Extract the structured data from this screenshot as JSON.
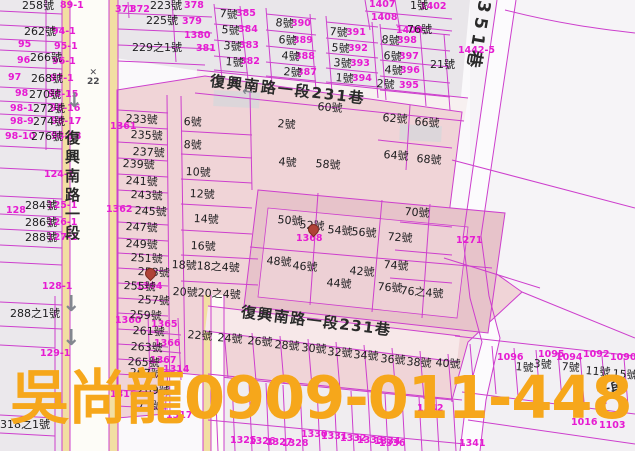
{
  "watermark": {
    "text": "吳尚龍0909-011-448",
    "color": "#f6a71b"
  },
  "street_labels": [
    {
      "text": "復興南路一段",
      "x": 64,
      "y": 130,
      "vertical": true,
      "fs": 15,
      "ls": 4
    },
    {
      "text": "復興南路一段231巷",
      "x": 211,
      "y": 74,
      "rot": 6.5,
      "fs": 15,
      "ls": 2
    },
    {
      "text": "復興南路一段231巷",
      "x": 242,
      "y": 305,
      "rot": 7,
      "fs": 15,
      "ls": 1.5
    },
    {
      "text": "351巷",
      "x": 492,
      "y": 2,
      "rot": 100,
      "fs": 17,
      "ls": 5
    },
    {
      "text": "一段",
      "x": 596,
      "y": 386,
      "rot": -12,
      "fs": 13,
      "ls": 1
    }
  ],
  "house_numbers": [
    {
      "t": "258號",
      "x": 22,
      "y": 0
    },
    {
      "t": "262號",
      "x": 24,
      "y": 26
    },
    {
      "t": "266號",
      "x": 30,
      "y": 52
    },
    {
      "t": "268號",
      "x": 31,
      "y": 73
    },
    {
      "t": "270號",
      "x": 29,
      "y": 89
    },
    {
      "t": "272號",
      "x": 33,
      "y": 103
    },
    {
      "t": "274號",
      "x": 33,
      "y": 116
    },
    {
      "t": "276號",
      "x": 31,
      "y": 131
    },
    {
      "t": "284號",
      "x": 25,
      "y": 200
    },
    {
      "t": "286號",
      "x": 25,
      "y": 217
    },
    {
      "t": "288號",
      "x": 25,
      "y": 232
    },
    {
      "t": "288之1號",
      "x": 10,
      "y": 308
    },
    {
      "t": "318之1號",
      "x": 0,
      "y": 419
    },
    {
      "t": "223號",
      "x": 150,
      "y": 0
    },
    {
      "t": "225號",
      "x": 146,
      "y": 15
    },
    {
      "t": "229之1號",
      "x": 132,
      "y": 42
    },
    {
      "t": "1號",
      "x": 410,
      "y": 0
    },
    {
      "t": "76號",
      "x": 407,
      "y": 24
    },
    {
      "t": "21號",
      "x": 430,
      "y": 59
    },
    {
      "t": "7號",
      "x": 220,
      "y": 8,
      "rot": 5
    },
    {
      "t": "5號",
      "x": 222,
      "y": 24,
      "rot": 5
    },
    {
      "t": "3號",
      "x": 224,
      "y": 40,
      "rot": 5
    },
    {
      "t": "1號",
      "x": 226,
      "y": 56,
      "rot": 5
    },
    {
      "t": "8號",
      "x": 276,
      "y": 17,
      "rot": 5
    },
    {
      "t": "6號",
      "x": 279,
      "y": 34,
      "rot": 5
    },
    {
      "t": "4號",
      "x": 282,
      "y": 50,
      "rot": 5
    },
    {
      "t": "2號",
      "x": 284,
      "y": 66,
      "rot": 5
    },
    {
      "t": "7號",
      "x": 330,
      "y": 26,
      "rot": 5
    },
    {
      "t": "5號",
      "x": 332,
      "y": 42,
      "rot": 5
    },
    {
      "t": "3號",
      "x": 334,
      "y": 57,
      "rot": 5
    },
    {
      "t": "1號",
      "x": 336,
      "y": 72,
      "rot": 5
    },
    {
      "t": "8號",
      "x": 382,
      "y": 34,
      "rot": 5
    },
    {
      "t": "6號",
      "x": 384,
      "y": 50,
      "rot": 5
    },
    {
      "t": "4號",
      "x": 385,
      "y": 64,
      "rot": 5
    },
    {
      "t": "2號",
      "x": 377,
      "y": 78,
      "rot": 5
    },
    {
      "t": "233號",
      "x": 126,
      "y": 113,
      "rot": 3
    },
    {
      "t": "235號",
      "x": 131,
      "y": 129,
      "rot": 3
    },
    {
      "t": "237號",
      "x": 133,
      "y": 146,
      "rot": 3
    },
    {
      "t": "239號",
      "x": 123,
      "y": 158,
      "rot": 3
    },
    {
      "t": "241號",
      "x": 126,
      "y": 175,
      "rot": 3
    },
    {
      "t": "243號",
      "x": 131,
      "y": 189,
      "rot": 3
    },
    {
      "t": "245號",
      "x": 135,
      "y": 205,
      "rot": 3
    },
    {
      "t": "247號",
      "x": 126,
      "y": 221,
      "rot": 3
    },
    {
      "t": "249號",
      "x": 126,
      "y": 238,
      "rot": 3
    },
    {
      "t": "251號",
      "x": 131,
      "y": 252,
      "rot": 3
    },
    {
      "t": "253號",
      "x": 138,
      "y": 266,
      "rot": 3
    },
    {
      "t": "255號",
      "x": 124,
      "y": 280,
      "rot": 3
    },
    {
      "t": "257號",
      "x": 138,
      "y": 294,
      "rot": 3
    },
    {
      "t": "259號",
      "x": 130,
      "y": 309,
      "rot": 3
    },
    {
      "t": "261號",
      "x": 133,
      "y": 325,
      "rot": 3
    },
    {
      "t": "263號",
      "x": 131,
      "y": 341,
      "rot": 3
    },
    {
      "t": "265號",
      "x": 128,
      "y": 356,
      "rot": 3
    },
    {
      "t": "267號",
      "x": 130,
      "y": 367,
      "rot": 3
    },
    {
      "t": "269號",
      "x": 138,
      "y": 384,
      "rot": 3
    },
    {
      "t": "271號",
      "x": 131,
      "y": 399,
      "rot": 3
    },
    {
      "t": "6號",
      "x": 184,
      "y": 116,
      "rot": 3
    },
    {
      "t": "8號",
      "x": 184,
      "y": 139,
      "rot": 3
    },
    {
      "t": "10號",
      "x": 186,
      "y": 166,
      "rot": 3
    },
    {
      "t": "12號",
      "x": 190,
      "y": 188,
      "rot": 3
    },
    {
      "t": "14號",
      "x": 194,
      "y": 213,
      "rot": 3
    },
    {
      "t": "16號",
      "x": 191,
      "y": 240,
      "rot": 3
    },
    {
      "t": "18號18之4號",
      "x": 172,
      "y": 259,
      "rot": 3
    },
    {
      "t": "20號20之4號",
      "x": 173,
      "y": 286,
      "rot": 3
    },
    {
      "t": "2號",
      "x": 278,
      "y": 118,
      "rot": 5
    },
    {
      "t": "60號",
      "x": 318,
      "y": 101,
      "rot": 5
    },
    {
      "t": "62號",
      "x": 383,
      "y": 112,
      "rot": 5
    },
    {
      "t": "66號",
      "x": 415,
      "y": 116,
      "rot": 5
    },
    {
      "t": "64號",
      "x": 384,
      "y": 149,
      "rot": 5
    },
    {
      "t": "68號",
      "x": 417,
      "y": 153,
      "rot": 5
    },
    {
      "t": "4號",
      "x": 279,
      "y": 156,
      "rot": 5
    },
    {
      "t": "58號",
      "x": 316,
      "y": 158,
      "rot": 5
    },
    {
      "t": "50號",
      "x": 278,
      "y": 214,
      "rot": 5
    },
    {
      "t": "52號",
      "x": 300,
      "y": 219,
      "rot": 5
    },
    {
      "t": "54號",
      "x": 328,
      "y": 224,
      "rot": 5
    },
    {
      "t": "56號",
      "x": 352,
      "y": 226,
      "rot": 5
    },
    {
      "t": "48號",
      "x": 267,
      "y": 255,
      "rot": 5
    },
    {
      "t": "46號",
      "x": 293,
      "y": 260,
      "rot": 5
    },
    {
      "t": "44號",
      "x": 327,
      "y": 277,
      "rot": 5
    },
    {
      "t": "42號",
      "x": 350,
      "y": 265,
      "rot": 5
    },
    {
      "t": "70號",
      "x": 405,
      "y": 206,
      "rot": 5
    },
    {
      "t": "72號",
      "x": 388,
      "y": 231,
      "rot": 5
    },
    {
      "t": "74號",
      "x": 384,
      "y": 259,
      "rot": 5
    },
    {
      "t": "76號",
      "x": 378,
      "y": 281,
      "rot": 5
    },
    {
      "t": "76之4號",
      "x": 401,
      "y": 285,
      "rot": 5
    },
    {
      "t": "22號",
      "x": 188,
      "y": 329,
      "rot": 5
    },
    {
      "t": "24號",
      "x": 218,
      "y": 332,
      "rot": 5
    },
    {
      "t": "26號",
      "x": 248,
      "y": 335,
      "rot": 5
    },
    {
      "t": "28號",
      "x": 275,
      "y": 339,
      "rot": 5
    },
    {
      "t": "30號",
      "x": 302,
      "y": 342,
      "rot": 5
    },
    {
      "t": "32號",
      "x": 328,
      "y": 346,
      "rot": 5
    },
    {
      "t": "34號",
      "x": 354,
      "y": 349,
      "rot": 5
    },
    {
      "t": "36號",
      "x": 381,
      "y": 353,
      "rot": 5
    },
    {
      "t": "38號",
      "x": 407,
      "y": 356,
      "rot": 5
    },
    {
      "t": "40號",
      "x": 436,
      "y": 357,
      "rot": 5
    },
    {
      "t": "1號",
      "x": 516,
      "y": 361,
      "rot": 5
    },
    {
      "t": "3號",
      "x": 534,
      "y": 358,
      "rot": 5
    },
    {
      "t": "7號",
      "x": 562,
      "y": 361,
      "rot": 5
    },
    {
      "t": "11號",
      "x": 586,
      "y": 365,
      "rot": 5
    },
    {
      "t": "15號",
      "x": 613,
      "y": 368,
      "rot": 5
    }
  ],
  "lot_numbers": [
    {
      "t": "89-1",
      "x": 60,
      "y": 1
    },
    {
      "t": "94-1",
      "x": 52,
      "y": 27
    },
    {
      "t": "95",
      "x": 18,
      "y": 40
    },
    {
      "t": "95-1",
      "x": 54,
      "y": 42
    },
    {
      "t": "96",
      "x": 17,
      "y": 56
    },
    {
      "t": "96-1",
      "x": 52,
      "y": 57
    },
    {
      "t": "97",
      "x": 8,
      "y": 73
    },
    {
      "t": "97-1",
      "x": 50,
      "y": 74
    },
    {
      "t": "98",
      "x": 15,
      "y": 89
    },
    {
      "t": "98-15",
      "x": 48,
      "y": 90
    },
    {
      "t": "98-1",
      "x": 10,
      "y": 104
    },
    {
      "t": "98-16",
      "x": 50,
      "y": 104
    },
    {
      "t": "98-9",
      "x": 10,
      "y": 117
    },
    {
      "t": "98-17",
      "x": 51,
      "y": 117
    },
    {
      "t": "98-10",
      "x": 5,
      "y": 132
    },
    {
      "t": "98-18",
      "x": 51,
      "y": 132
    },
    {
      "t": "124-1",
      "x": 44,
      "y": 170
    },
    {
      "t": "125-1",
      "x": 47,
      "y": 201
    },
    {
      "t": "128",
      "x": 6,
      "y": 206
    },
    {
      "t": "126-1",
      "x": 47,
      "y": 218
    },
    {
      "t": "127-1",
      "x": 47,
      "y": 233
    },
    {
      "t": "128-1",
      "x": 42,
      "y": 282
    },
    {
      "t": "129-1",
      "x": 40,
      "y": 349
    },
    {
      "t": "371",
      "x": 115,
      "y": 5
    },
    {
      "t": "372",
      "x": 130,
      "y": 5
    },
    {
      "t": "378",
      "x": 184,
      "y": 1
    },
    {
      "t": "379",
      "x": 182,
      "y": 17
    },
    {
      "t": "1380",
      "x": 184,
      "y": 31
    },
    {
      "t": "381",
      "x": 196,
      "y": 44
    },
    {
      "t": "1407",
      "x": 369,
      "y": 0
    },
    {
      "t": "1408",
      "x": 371,
      "y": 13
    },
    {
      "t": "1402",
      "x": 420,
      "y": 2
    },
    {
      "t": "1406",
      "x": 396,
      "y": 26
    },
    {
      "t": "1442-5",
      "x": 458,
      "y": 46
    },
    {
      "t": "1271",
      "x": 456,
      "y": 236
    },
    {
      "t": "385",
      "x": 236,
      "y": 9
    },
    {
      "t": "384",
      "x": 238,
      "y": 25
    },
    {
      "t": "383",
      "x": 239,
      "y": 41
    },
    {
      "t": "382",
      "x": 240,
      "y": 57
    },
    {
      "t": "390",
      "x": 291,
      "y": 19
    },
    {
      "t": "389",
      "x": 293,
      "y": 36
    },
    {
      "t": "388",
      "x": 295,
      "y": 52
    },
    {
      "t": "387",
      "x": 297,
      "y": 68
    },
    {
      "t": "391",
      "x": 346,
      "y": 28
    },
    {
      "t": "392",
      "x": 348,
      "y": 44
    },
    {
      "t": "393",
      "x": 350,
      "y": 59
    },
    {
      "t": "394",
      "x": 352,
      "y": 74
    },
    {
      "t": "398",
      "x": 397,
      "y": 36
    },
    {
      "t": "397",
      "x": 399,
      "y": 52
    },
    {
      "t": "396",
      "x": 400,
      "y": 66
    },
    {
      "t": "395",
      "x": 399,
      "y": 81
    },
    {
      "t": "1361",
      "x": 110,
      "y": 122
    },
    {
      "t": "1362",
      "x": 106,
      "y": 205
    },
    {
      "t": "1364",
      "x": 136,
      "y": 282
    },
    {
      "t": "1360",
      "x": 115,
      "y": 316
    },
    {
      "t": "1365",
      "x": 151,
      "y": 320
    },
    {
      "t": "1366",
      "x": 154,
      "y": 339
    },
    {
      "t": "1367",
      "x": 150,
      "y": 356
    },
    {
      "t": "1314",
      "x": 163,
      "y": 365
    },
    {
      "t": "1316",
      "x": 110,
      "y": 390
    },
    {
      "t": "1317",
      "x": 166,
      "y": 411
    },
    {
      "t": "1368",
      "x": 296,
      "y": 234
    },
    {
      "t": "1096",
      "x": 497,
      "y": 353
    },
    {
      "t": "1095",
      "x": 538,
      "y": 350
    },
    {
      "t": "1094",
      "x": 556,
      "y": 353
    },
    {
      "t": "1092",
      "x": 583,
      "y": 350
    },
    {
      "t": "1090",
      "x": 610,
      "y": 353
    },
    {
      "t": "1016",
      "x": 571,
      "y": 418
    },
    {
      "t": "1103",
      "x": 599,
      "y": 421
    },
    {
      "t": "1342",
      "x": 417,
      "y": 404
    },
    {
      "t": "1341",
      "x": 459,
      "y": 439
    },
    {
      "t": "1336",
      "x": 379,
      "y": 439
    },
    {
      "t": "1325",
      "x": 230,
      "y": 436
    },
    {
      "t": "1326",
      "x": 249,
      "y": 437
    },
    {
      "t": "1327",
      "x": 266,
      "y": 438
    },
    {
      "t": "1328",
      "x": 282,
      "y": 439
    },
    {
      "t": "1330",
      "x": 301,
      "y": 430
    },
    {
      "t": "1331",
      "x": 321,
      "y": 432
    },
    {
      "t": "1332",
      "x": 340,
      "y": 434
    },
    {
      "t": "1333",
      "x": 357,
      "y": 436
    },
    {
      "t": "1334",
      "x": 374,
      "y": 437
    }
  ],
  "markers": {
    "arrows": [
      {
        "g": "↓",
        "x": 66,
        "y": 90,
        "fs": 20
      },
      {
        "g": "↓",
        "x": 62,
        "y": 294,
        "fs": 22
      },
      {
        "g": "↓",
        "x": 62,
        "y": 328,
        "fs": 22
      },
      {
        "g": "←",
        "x": 243,
        "y": 85,
        "fs": 13,
        "rot": 7
      }
    ],
    "station": {
      "symbol": "✕",
      "label": "22",
      "x": 87,
      "y": 69
    },
    "pins": [
      {
        "x": 308,
        "y": 224
      },
      {
        "x": 145,
        "y": 268
      }
    ]
  },
  "colors": {
    "line_magenta": "#cd3fcd",
    "lot_text": "#e61bd2",
    "pink_block": "#f0d4d7",
    "pink_inner": "#e7c3ca",
    "road_yellow": "#f2dfa2",
    "watermark_amber": "#f6a71b"
  }
}
